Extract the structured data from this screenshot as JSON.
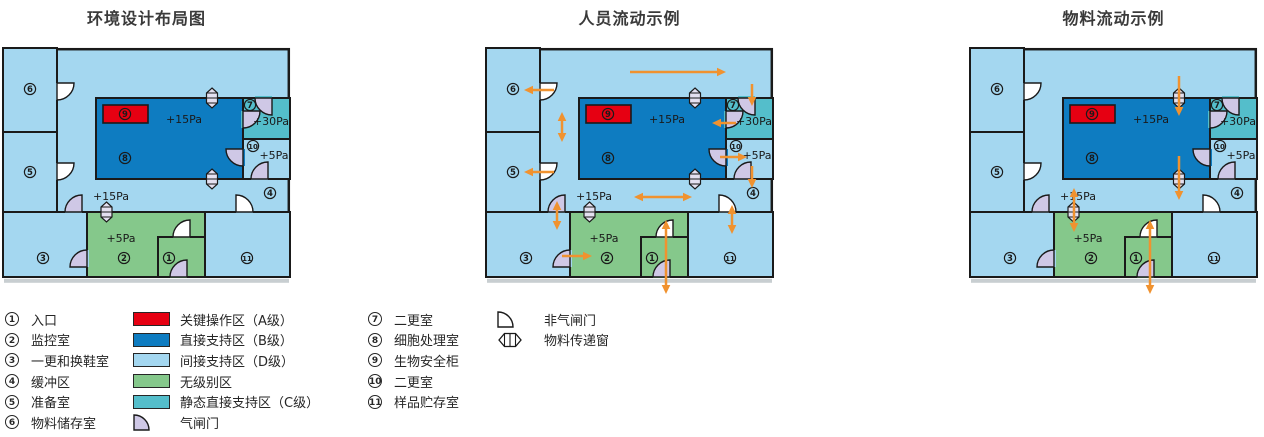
{
  "colors": {
    "lightBlue": "#A4D7F0",
    "darkBlue": "#0E7CC1",
    "teal": "#54BECB",
    "green": "#85C88B",
    "red": "#E60012",
    "lavender": "#CFC8E6",
    "doorWhite": "#FFFFFF",
    "windowFill": "#E4E0F0",
    "orange": "#F0922F",
    "wall": "#1A1A1A",
    "shadow": "#C8CED1",
    "text": "#1A1A1A"
  },
  "diagrams": [
    {
      "title": "环境设计布局图",
      "arrows": []
    },
    {
      "title": "人员流动示例",
      "arrows": [
        {
          "x1": 144,
          "y1": 24,
          "x2": 240,
          "y2": 24,
          "double": false
        },
        {
          "x1": 68,
          "y1": 42,
          "x2": 38,
          "y2": 42,
          "double": false
        },
        {
          "x1": 76,
          "y1": 64,
          "x2": 76,
          "y2": 94,
          "double": true
        },
        {
          "x1": 266,
          "y1": 36,
          "x2": 266,
          "y2": 58,
          "double": false
        },
        {
          "x1": 250,
          "y1": 75,
          "x2": 226,
          "y2": 75,
          "double": false
        },
        {
          "x1": 234,
          "y1": 109,
          "x2": 261,
          "y2": 109,
          "double": false
        },
        {
          "x1": 266,
          "y1": 118,
          "x2": 266,
          "y2": 140,
          "double": false
        },
        {
          "x1": 68,
          "y1": 124,
          "x2": 38,
          "y2": 124,
          "double": false
        },
        {
          "x1": 71,
          "y1": 153,
          "x2": 71,
          "y2": 182,
          "double": true
        },
        {
          "x1": 148,
          "y1": 149,
          "x2": 206,
          "y2": 149,
          "double": true
        },
        {
          "x1": 246,
          "y1": 157,
          "x2": 246,
          "y2": 186,
          "double": true
        },
        {
          "x1": 76,
          "y1": 208,
          "x2": 106,
          "y2": 208,
          "double": false
        },
        {
          "x1": 180,
          "y1": 172,
          "x2": 180,
          "y2": 246,
          "double": true
        }
      ]
    },
    {
      "title": "物料流动示例",
      "arrows": [
        {
          "x1": 209,
          "y1": 28,
          "x2": 209,
          "y2": 68,
          "double": false
        },
        {
          "x1": 209,
          "y1": 108,
          "x2": 209,
          "y2": 152,
          "double": false
        },
        {
          "x1": 104,
          "y1": 140,
          "x2": 104,
          "y2": 184,
          "double": true
        },
        {
          "x1": 180,
          "y1": 172,
          "x2": 180,
          "y2": 246,
          "double": true
        }
      ]
    }
  ],
  "floorplan": {
    "width": 287,
    "height": 229,
    "rooms": [
      {
        "name": "room-6",
        "x": 0,
        "y": 0,
        "w": 54,
        "h": 84,
        "fill": "lightBlue"
      },
      {
        "name": "room-5",
        "x": 0,
        "y": 84,
        "w": 54,
        "h": 80,
        "fill": "lightBlue"
      },
      {
        "name": "room-3",
        "x": 0,
        "y": 164,
        "w": 84,
        "h": 65,
        "fill": "lightBlue"
      },
      {
        "name": "room-2",
        "x": 84,
        "y": 164,
        "w": 118,
        "h": 65,
        "fill": "green"
      },
      {
        "name": "room-11",
        "x": 202,
        "y": 164,
        "w": 85,
        "h": 65,
        "fill": "lightBlue"
      },
      {
        "name": "room-1",
        "x": 155,
        "y": 189,
        "w": 47,
        "h": 40,
        "fill": "green"
      },
      {
        "name": "room-8",
        "x": 93,
        "y": 50,
        "w": 147,
        "h": 81,
        "fill": "darkBlue"
      },
      {
        "name": "room-7",
        "x": 240,
        "y": 50,
        "w": 47,
        "h": 41,
        "fill": "teal"
      },
      {
        "name": "room-10",
        "x": 240,
        "y": 91,
        "w": 47,
        "h": 40,
        "fill": "lightBlue"
      }
    ],
    "equipment": [
      {
        "name": "biosafety-cabinet-9",
        "x": 100,
        "y": 57,
        "w": 45,
        "h": 18,
        "fill": "red"
      }
    ],
    "doors": [
      {
        "x": 54,
        "y": 35,
        "corner": "tl",
        "type": "plain",
        "gx": 52,
        "gy": 35,
        "gw": 4,
        "gh": 17,
        "gap": "lightBlue"
      },
      {
        "x": 54,
        "y": 115,
        "corner": "tl",
        "type": "plain",
        "gx": 52,
        "gy": 115,
        "gw": 4,
        "gh": 17,
        "gap": "lightBlue"
      },
      {
        "x": 62,
        "y": 147,
        "corner": "br",
        "type": "air",
        "gx": 62,
        "gy": 162,
        "gw": 17,
        "gh": 4,
        "gap": "lightBlue"
      },
      {
        "x": 67,
        "y": 202,
        "corner": "br",
        "type": "air",
        "gx": 82,
        "gy": 202,
        "gw": 4,
        "gh": 17,
        "gap": "lightBlue"
      },
      {
        "x": 170,
        "y": 172,
        "corner": "br",
        "type": "plain",
        "gx": 170,
        "gy": 187,
        "gw": 17,
        "gh": 4,
        "gap": "green"
      },
      {
        "x": 167,
        "y": 212,
        "corner": "br",
        "type": "air",
        "gx": 167,
        "gy": 226.5,
        "gw": 17,
        "gh": 3.5,
        "gap": "green"
      },
      {
        "x": 233,
        "y": 147,
        "corner": "bl",
        "type": "plain",
        "gx": 233,
        "gy": 162,
        "gw": 17,
        "gh": 4,
        "gap": "lightBlue"
      },
      {
        "x": 248,
        "y": 114,
        "corner": "br",
        "type": "air",
        "gx": 248,
        "gy": 129,
        "gw": 17,
        "gh": 4,
        "gap": "lightBlue"
      },
      {
        "x": 252,
        "y": 50,
        "corner": "tr",
        "type": "air",
        "gx": 252,
        "gy": 48,
        "gw": 17,
        "gh": 4,
        "gap": "teal"
      },
      {
        "x": 240,
        "y": 63,
        "corner": "tl",
        "type": "air",
        "gx": 238,
        "gy": 63,
        "gw": 4,
        "gh": 17,
        "gap": "teal"
      },
      {
        "x": 223,
        "y": 101,
        "corner": "tr",
        "type": "air",
        "gx": 238,
        "gy": 101,
        "gw": 4,
        "gh": 17,
        "gap": "darkBlue"
      }
    ],
    "windows": [
      {
        "cx": 209,
        "cy": 50
      },
      {
        "cx": 209,
        "cy": 131
      },
      {
        "cx": 103.5,
        "cy": 164
      }
    ],
    "room_labels": [
      {
        "n": "6",
        "x": 27,
        "y": 41
      },
      {
        "n": "5",
        "x": 27,
        "y": 124
      },
      {
        "n": "3",
        "x": 40,
        "y": 210
      },
      {
        "n": "2",
        "x": 121,
        "y": 210
      },
      {
        "n": "1",
        "x": 166,
        "y": 210
      },
      {
        "n": "11",
        "x": 244,
        "y": 210
      },
      {
        "n": "4",
        "x": 267,
        "y": 145
      },
      {
        "n": "7",
        "x": 247,
        "y": 57
      },
      {
        "n": "10",
        "x": 250,
        "y": 98
      },
      {
        "n": "8",
        "x": 122,
        "y": 110
      },
      {
        "n": "9",
        "x": 122,
        "y": 66
      }
    ],
    "pressure_labels": [
      {
        "text": "+15Pa",
        "x": 181,
        "y": 71
      },
      {
        "text": "+30Pa",
        "x": 268,
        "y": 73
      },
      {
        "text": "+5Pa",
        "x": 271,
        "y": 107
      },
      {
        "text": "+15Pa",
        "x": 108,
        "y": 148
      },
      {
        "text": "+5Pa",
        "x": 118,
        "y": 190
      }
    ]
  },
  "legend": {
    "columns": [
      {
        "x": 5,
        "numcol": true,
        "items": [
          {
            "kind": "num",
            "v": "1",
            "label": "入口"
          },
          {
            "kind": "num",
            "v": "2",
            "label": "监控室"
          },
          {
            "kind": "num",
            "v": "3",
            "label": "一更和换鞋室"
          },
          {
            "kind": "num",
            "v": "4",
            "label": "缓冲区"
          },
          {
            "kind": "num",
            "v": "5",
            "label": "准备室"
          },
          {
            "kind": "num",
            "v": "6",
            "label": "物料储存室"
          }
        ]
      },
      {
        "x": 133,
        "numcol": false,
        "items": [
          {
            "kind": "swatch",
            "v": "red",
            "label": "关键操作区（A级）"
          },
          {
            "kind": "swatch",
            "v": "darkBlue",
            "label": "直接支持区（B级）"
          },
          {
            "kind": "swatch",
            "v": "lightBlue",
            "label": "间接支持区（D级）"
          },
          {
            "kind": "swatch",
            "v": "green",
            "label": "无级别区"
          },
          {
            "kind": "swatch",
            "v": "teal",
            "label": "静态直接支持区（C级）"
          },
          {
            "kind": "door",
            "v": "air",
            "label": "气闸门"
          }
        ]
      },
      {
        "x": 368,
        "numcol": true,
        "items": [
          {
            "kind": "num",
            "v": "7",
            "label": "二更室"
          },
          {
            "kind": "num",
            "v": "8",
            "label": "细胞处理室"
          },
          {
            "kind": "num",
            "v": "9",
            "label": "生物安全柜"
          },
          {
            "kind": "num",
            "v": "10",
            "label": "二更室"
          },
          {
            "kind": "num",
            "v": "11",
            "label": "样品贮存室"
          }
        ]
      },
      {
        "x": 497,
        "numcol": false,
        "items": [
          {
            "kind": "door",
            "v": "plain",
            "label": "非气闸门"
          },
          {
            "kind": "window",
            "v": "h",
            "label": "物料传递窗"
          }
        ]
      }
    ]
  }
}
